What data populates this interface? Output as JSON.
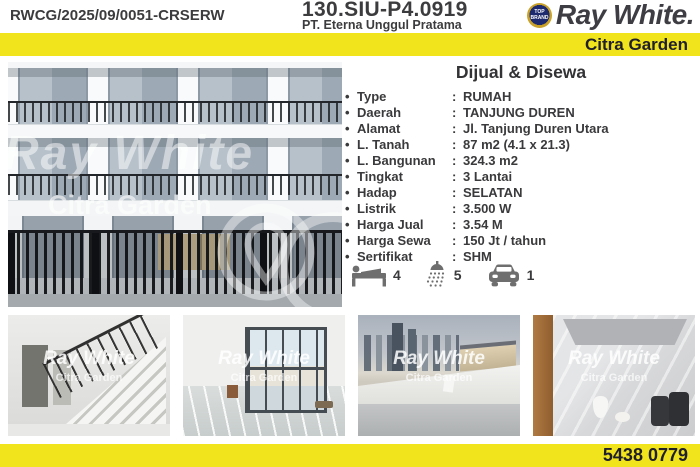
{
  "header": {
    "ref_code": "RWCG/2025/09/0051-CRSERW",
    "license": "130.SIU-P4.0919",
    "company": "PT. Eterna Unggul Pratama",
    "badge": "TOP BRAND",
    "brand": "Ray White.",
    "office": "Citra Garden"
  },
  "listing": {
    "title": "Dijual & Disewa",
    "bullet": "•",
    "colon": ":",
    "details": [
      {
        "label": "Type",
        "value": "RUMAH"
      },
      {
        "label": "Daerah",
        "value": "TANJUNG DUREN"
      },
      {
        "label": "Alamat",
        "value": "Jl. Tanjung Duren Utara"
      },
      {
        "label": "L. Tanah",
        "value": "87 m2 (4.1 x 21.3)"
      },
      {
        "label": "L. Bangunan",
        "value": "324.3 m2"
      },
      {
        "label": "Tingkat",
        "value": "3 Lantai"
      },
      {
        "label": "Hadap",
        "value": "SELATAN"
      },
      {
        "label": "Listrik",
        "value": "3.500 W"
      },
      {
        "label": "Harga Jual",
        "value": "3.54 M"
      },
      {
        "label": "Harga Sewa",
        "value": "150 Jt / tahun"
      },
      {
        "label": "Sertifikat",
        "value": "SHM"
      }
    ],
    "features": [
      {
        "icon": "bed-icon",
        "count": "4"
      },
      {
        "icon": "shower-icon",
        "count": "5"
      },
      {
        "icon": "car-icon",
        "count": "1"
      }
    ]
  },
  "watermark": {
    "brand": "Ray White",
    "office": "Citra Garden"
  },
  "footer": {
    "phone": "5438 0779"
  },
  "colors": {
    "accent_yellow": "#F2E41C",
    "text_dark": "#3B3B3D",
    "navy_text": "#20202C",
    "icon_gray": "#6E6E6E"
  }
}
